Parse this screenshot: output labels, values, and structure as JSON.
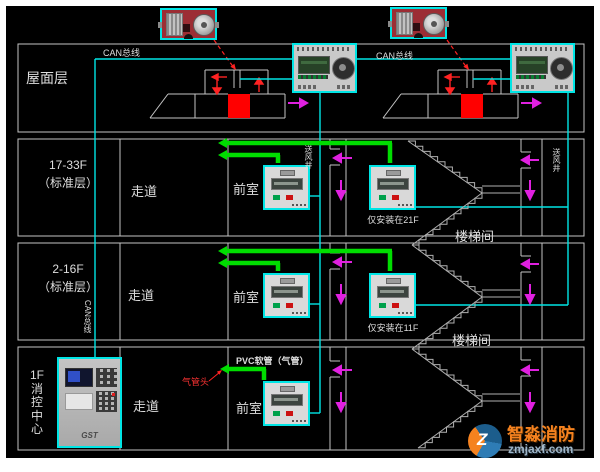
{
  "labels": {
    "roof": "屋面层",
    "floor_17_33": "17-33F",
    "floor_17_33_sub": "（标准层）",
    "floor_2_16": "2-16F",
    "floor_2_16_sub": "（标准层）",
    "floor_1f": "1F\n消\n控\n中\n心",
    "corridor": "走道",
    "front_room": "前室",
    "stairwell": "楼梯间",
    "can_bus": "CAN总线",
    "only_21f": "仅安装在21F",
    "only_11f": "仅安装在11F",
    "pvc_pipe": "PVC软管（气管）",
    "air_tube_head": "气管头",
    "supply_shaft": "送风井",
    "brand": "GST"
  },
  "watermark": {
    "name": "智淼消防",
    "site": "zmjaxf.com"
  },
  "colors": {
    "background": "#000000",
    "frame": "#c4c4c4",
    "can_bus_wire": "#00e5e5",
    "air_pipe": "#00dd00",
    "airflow_arrow": "#e020e0",
    "damper": "#ff0000",
    "actuator_photo": "#9c2d34",
    "watermark_orange": "#f5821f"
  },
  "icons": {
    "actuator_photo": "damper-actuator-photo",
    "controller": "pressure-controller-panel",
    "sensor": "pressure-sensor-panel",
    "cabinet": "fire-control-host-cabinet",
    "damper": "fire-damper",
    "stairs": "staircase"
  }
}
